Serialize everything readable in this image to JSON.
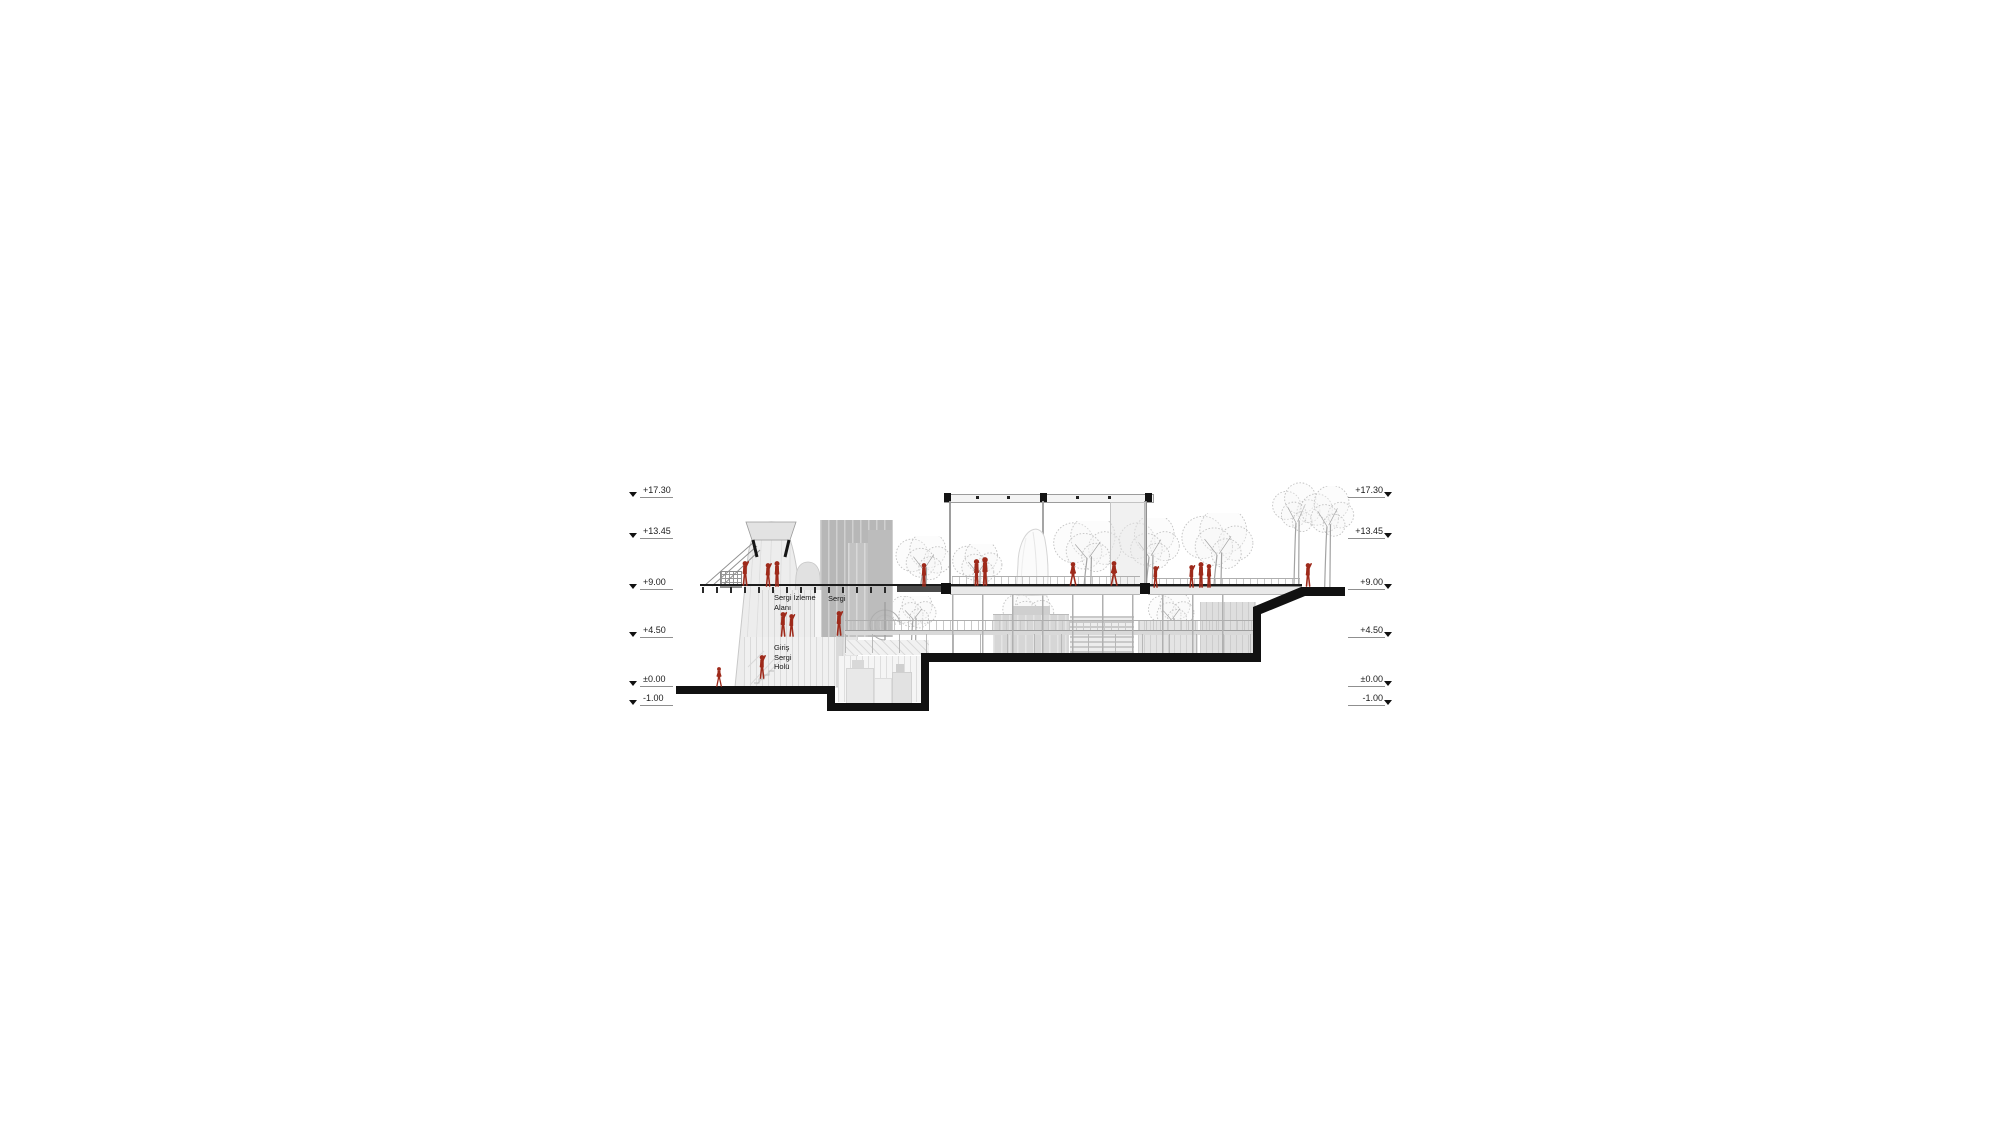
{
  "page": {
    "background": "#ffffff",
    "kind": "architectural-section-drawing"
  },
  "drawing": {
    "levels": [
      {
        "label": "+17.30",
        "y": 497
      },
      {
        "label": "+13.45",
        "y": 538
      },
      {
        "label": "+9.00",
        "y": 589
      },
      {
        "label": "+4.50",
        "y": 637
      },
      {
        "label": "±0.00",
        "y": 686
      },
      {
        "label": "-1.00",
        "y": 705
      }
    ],
    "labels": {
      "room_upper_line1": "Sergi İzleme",
      "room_upper_line2": "Alanı",
      "room_side": "Sergi",
      "hall_line1": "Giriş",
      "hall_line2": "Sergi",
      "hall_line3": "Holü"
    },
    "colors": {
      "figure_red": "#9e2a1b",
      "section_cut": "#111111",
      "tree_stroke": "#c2c2c2",
      "trunk": "#a3a3a3",
      "light_gray": "#ececec",
      "mid_gray": "#b7b7b7"
    },
    "figures": [
      {
        "x": 714,
        "y": 667,
        "h": 20,
        "p": "walk"
      },
      {
        "x": 756,
        "y": 655,
        "h": 24,
        "p": "reach"
      },
      {
        "x": 739,
        "y": 561,
        "h": 25,
        "p": "reach"
      },
      {
        "x": 762,
        "y": 563,
        "h": 24,
        "p": "reach"
      },
      {
        "x": 771,
        "y": 561,
        "h": 26,
        "p": "stand"
      },
      {
        "x": 777,
        "y": 612,
        "h": 25,
        "p": "reach"
      },
      {
        "x": 786,
        "y": 614,
        "h": 23,
        "p": "reach"
      },
      {
        "x": 833,
        "y": 611,
        "h": 25,
        "p": "reach"
      },
      {
        "x": 918,
        "y": 563,
        "h": 24,
        "p": "stand"
      },
      {
        "x": 970,
        "y": 559,
        "h": 27,
        "p": "stand"
      },
      {
        "x": 978,
        "y": 557,
        "h": 29,
        "p": "stand"
      },
      {
        "x": 1067,
        "y": 562,
        "h": 24,
        "p": "walk"
      },
      {
        "x": 1108,
        "y": 561,
        "h": 25,
        "p": "walk"
      },
      {
        "x": 1150,
        "y": 566,
        "h": 22,
        "p": "reach"
      },
      {
        "x": 1186,
        "y": 565,
        "h": 23,
        "p": "reach"
      },
      {
        "x": 1195,
        "y": 562,
        "h": 26,
        "p": "stand"
      },
      {
        "x": 1203,
        "y": 564,
        "h": 24,
        "p": "stand"
      },
      {
        "x": 1302,
        "y": 563,
        "h": 24,
        "p": "reach"
      }
    ],
    "trees": [
      {
        "x": 893,
        "y": 536,
        "w": 60,
        "h": 52,
        "ch": 46
      },
      {
        "x": 950,
        "y": 544,
        "w": 54,
        "h": 44,
        "ch": 40
      },
      {
        "x": 1050,
        "y": 521,
        "w": 74,
        "h": 66,
        "ch": 52
      },
      {
        "x": 1116,
        "y": 518,
        "w": 66,
        "h": 69,
        "ch": 54
      },
      {
        "x": 1178,
        "y": 513,
        "w": 78,
        "h": 74,
        "ch": 58
      },
      {
        "x": 1270,
        "y": 481,
        "w": 52,
        "h": 106,
        "ch": 58
      },
      {
        "x": 1298,
        "y": 486,
        "w": 58,
        "h": 101,
        "ch": 56
      },
      {
        "x": 888,
        "y": 596,
        "w": 50,
        "h": 56,
        "ch": 32
      },
      {
        "x": 1000,
        "y": 595,
        "w": 56,
        "h": 58,
        "ch": 34
      },
      {
        "x": 1146,
        "y": 595,
        "w": 50,
        "h": 58,
        "ch": 34
      }
    ]
  }
}
